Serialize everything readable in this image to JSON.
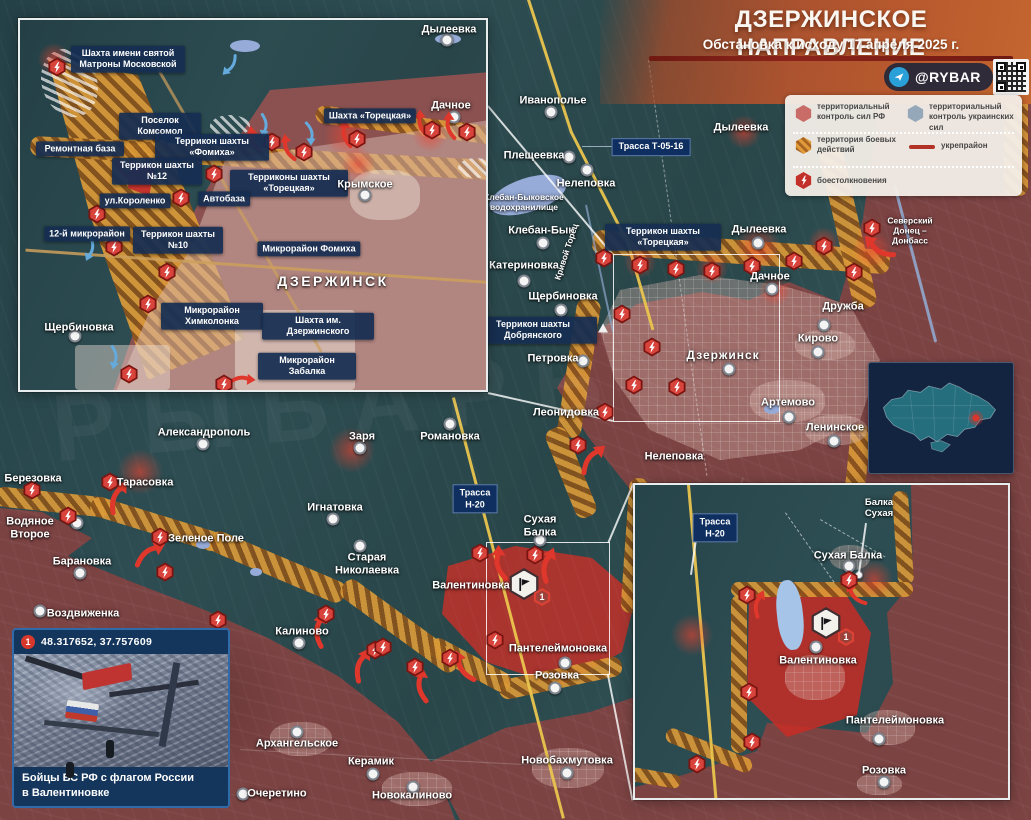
{
  "title": {
    "heading": "ДЗЕРЖИНСКОЕ НАПРАВЛЕНИЕ",
    "subtitle": "Обстановка к исходу 17 апреля 2025 г.",
    "channel": "@RYBAR"
  },
  "legend": {
    "rf_control": "территориальный контроль сил РФ",
    "ua_control": "территориальный контроль украинских сил",
    "combat_zone": "территория боевых действий",
    "fortified": "укрепрайон",
    "clashes": "боестолкновения"
  },
  "watermark": "РЫБАРЬ",
  "inset_city": {
    "matrona": "Шахта имени святой Матроны Московской",
    "dyleyevka": "Дылеевка",
    "dachnoye": "Дачное",
    "shahta_toretskaya": "Шахта «Торецкая»",
    "komsomol": "Поселок Комсомол",
    "remont_baza": "Ремонтная база",
    "terrikon_fomiha": "Террикон шахты «Фомиха»",
    "terrikon_12": "Террикон шахты №12",
    "terrikony_toretskaya": "Терриконы шахты «Торецкая»",
    "krymskoye": "Крымское",
    "korolenko": "ул.Короленко",
    "avtobaza": "Автобаза",
    "mikrorayon_12": "12-й микрорайон",
    "terrikon_10": "Террикон шахты №10",
    "mikrorayon_fomiha": "Микрорайон Фомиха",
    "dzerzhinsk": "ДЗЕРЖИНСК",
    "shcherbinovka": "Щербиновка",
    "himkolonka": "Микрорайон Химколонка",
    "shahta_dzerzhinskogo": "Шахта им. Дзержинского",
    "zabalka": "Микрорайон Забалка"
  },
  "main": {
    "ivanopolye": "Иванополье",
    "pleshcheyevka": "Плещеевка",
    "nelepovka_north": "Нелеповка",
    "trassa_t": "Трасса Т-05-16",
    "dyleyevka_north": "Дылеевка",
    "kleban_reservoir": "Клебан-Быковское водохранилище",
    "kleban_byk": "Клебан-Бык",
    "katerinovka": "Катериновка",
    "krivoy_torets": "Кривой Торец",
    "terrikon_toretskaya": "Террикон шахты «Торецкая»",
    "dyleyevka_south": "Дылеевка",
    "dachnoye": "Дачное",
    "shcherbinovka": "Щербиновка",
    "terrikon_dobryanskogo": "Террикон шахты Добрянского",
    "petrovka": "Петровка",
    "dzerzhinsk": "Дзержинск",
    "druzhba": "Дружба",
    "kirovo": "Кирово",
    "canal": "Северский Донец – Донбасс",
    "artemovo": "Артемово",
    "leninskoye": "Ленинское",
    "leonidovka": "Леонидовка",
    "nelepovka_south": "Нелеповка",
    "aleksandropol": "Александрополь",
    "berezovka": "Березовка",
    "tarasovka": "Тарасовка",
    "vodyanoye_vtoroye": "Водяное Второе",
    "zelenoye_pole": "Зеленое Поле",
    "baranovka": "Барановка",
    "vozdvizhenka": "Воздвиженка",
    "zarya": "Заря",
    "romanovka": "Романовка",
    "ignatovka": "Игнатовка",
    "trassa_n20": "Трасса\nН-20",
    "suhaya_balka": "Сухая Балка",
    "staraya_nikolayevka": "Старая Николаевка",
    "valentinovka": "Валентиновка",
    "kalinovo": "Калиново",
    "panteleymonovka": "Пантелеймоновка",
    "rozovka": "Розовка",
    "arhangelskoye": "Архангельское",
    "keramik": "Керамик",
    "ocheretino": "Очеретино",
    "novokalinovo": "Новокалиново",
    "novobahmutovka": "Новобахмутовка",
    "marker_1": "1"
  },
  "inset_valentinovka": {
    "trassa_n20": "Трасса\nН-20",
    "balka_suhaya": "Балка\nСухая",
    "suhaya_balka": "Сухая Балка",
    "valentinovka": "Валентиновка",
    "panteleymonovka": "Пантелеймоновка",
    "rozovka": "Розовка",
    "marker_1": "1"
  },
  "photo": {
    "marker": "1",
    "coords": "48.317652, 37.757609",
    "caption": "Бойцы ВС РФ с флагом России\nв Валентиновке"
  },
  "colors": {
    "rf_territory": "#7c4343",
    "ua_territory": "#2e4e52",
    "combat_band": "#dc9a37",
    "clash_icon": "#d8433c",
    "accent": "#b85a2e"
  }
}
